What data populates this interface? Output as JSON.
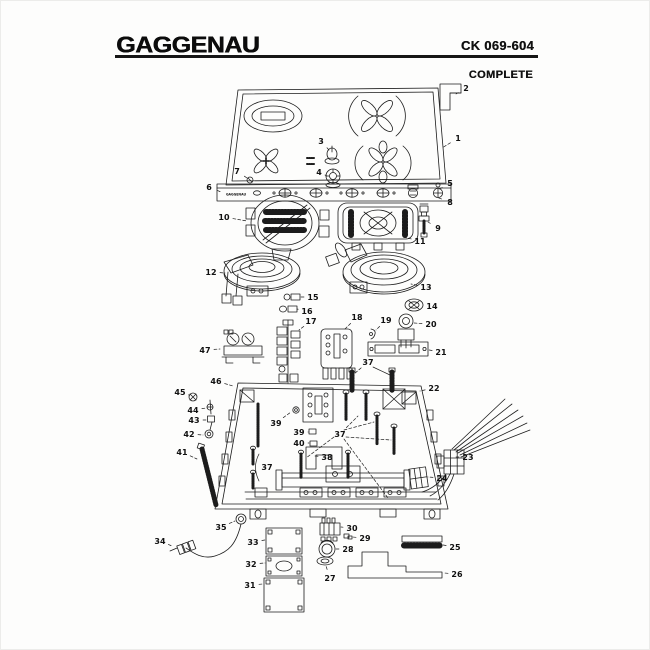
{
  "header": {
    "brand": "GAGGENAU",
    "model": "CK 069-604",
    "subtitle": "COMPLETE"
  },
  "diagram": {
    "strip_logo": "GAGGENAU",
    "labels": [
      {
        "n": "1",
        "x": 458,
        "y": 138,
        "tx": 442,
        "ty": 148
      },
      {
        "n": "2",
        "x": 466,
        "y": 88,
        "tx": 456,
        "ty": 94
      },
      {
        "n": "3",
        "x": 321,
        "y": 141,
        "tx": 329,
        "ty": 150
      },
      {
        "n": "4",
        "x": 319,
        "y": 172,
        "tx": 325,
        "ty": 175
      },
      {
        "n": "5",
        "x": 450,
        "y": 183,
        "tx": 438,
        "ty": 190
      },
      {
        "n": "6",
        "x": 209,
        "y": 187,
        "tx": 221,
        "ty": 192
      },
      {
        "n": "7",
        "x": 237,
        "y": 171,
        "tx": 247,
        "ty": 178
      },
      {
        "n": "8",
        "x": 450,
        "y": 202,
        "tx": 436,
        "ty": 197
      },
      {
        "n": "9",
        "x": 438,
        "y": 228,
        "tx": 428,
        "ty": 222
      },
      {
        "n": "10",
        "x": 224,
        "y": 217,
        "tx": 247,
        "ty": 221
      },
      {
        "n": "11",
        "x": 420,
        "y": 241,
        "tx": 403,
        "ty": 237
      },
      {
        "n": "12",
        "x": 211,
        "y": 272,
        "tx": 225,
        "ty": 273
      },
      {
        "n": "13",
        "x": 426,
        "y": 287,
        "tx": 411,
        "ty": 284
      },
      {
        "n": "14",
        "x": 432,
        "y": 306,
        "tx": 423,
        "ty": 305
      },
      {
        "n": "15",
        "x": 313,
        "y": 297,
        "tx": 300,
        "ty": 297
      },
      {
        "n": "16",
        "x": 307,
        "y": 311,
        "tx": 297,
        "ty": 309
      },
      {
        "n": "17",
        "x": 311,
        "y": 321,
        "tx": 299,
        "ty": 330
      },
      {
        "n": "18",
        "x": 357,
        "y": 317,
        "tx": 345,
        "ty": 329
      },
      {
        "n": "19",
        "x": 386,
        "y": 320,
        "tx": 376,
        "ty": 330
      },
      {
        "n": "20",
        "x": 431,
        "y": 324,
        "tx": 414,
        "ty": 323
      },
      {
        "n": "21",
        "x": 441,
        "y": 352,
        "tx": 429,
        "ty": 350
      },
      {
        "n": "22",
        "x": 434,
        "y": 388,
        "tx": 420,
        "ty": 391
      },
      {
        "n": "23",
        "x": 468,
        "y": 457,
        "tx": 455,
        "ty": 457
      },
      {
        "n": "24",
        "x": 442,
        "y": 478,
        "tx": 428,
        "ty": 477
      },
      {
        "n": "25",
        "x": 455,
        "y": 547,
        "tx": 443,
        "ty": 545
      },
      {
        "n": "26",
        "x": 457,
        "y": 574,
        "tx": 444,
        "ty": 573
      },
      {
        "n": "27",
        "x": 330,
        "y": 578,
        "tx": 326,
        "ty": 566
      },
      {
        "n": "28",
        "x": 348,
        "y": 549,
        "tx": 336,
        "ty": 549
      },
      {
        "n": "29",
        "x": 365,
        "y": 538,
        "tx": 352,
        "ty": 537
      },
      {
        "n": "30",
        "x": 352,
        "y": 528,
        "tx": 341,
        "ty": 527
      },
      {
        "n": "31",
        "x": 250,
        "y": 585,
        "tx": 263,
        "ty": 584
      },
      {
        "n": "32",
        "x": 251,
        "y": 564,
        "tx": 265,
        "ty": 563
      },
      {
        "n": "33",
        "x": 253,
        "y": 542,
        "tx": 265,
        "ty": 540
      },
      {
        "n": "34",
        "x": 160,
        "y": 541,
        "tx": 172,
        "ty": 546
      },
      {
        "n": "35",
        "x": 221,
        "y": 527,
        "tx": 235,
        "ty": 521
      },
      {
        "n": "37",
        "x": 368,
        "y": 362,
        "tx": 354,
        "ty": 374
      },
      {
        "n": "37",
        "x": 340,
        "y": 434,
        "tx": 358,
        "ty": 416
      },
      {
        "n": "37",
        "x": 267,
        "y": 467
      },
      {
        "n": "38",
        "x": 327,
        "y": 457,
        "tx": 315,
        "ty": 456
      },
      {
        "n": "39",
        "x": 276,
        "y": 423,
        "tx": 291,
        "ty": 412
      },
      {
        "n": "39",
        "x": 299,
        "y": 432,
        "tx": 308,
        "ty": 432
      },
      {
        "n": "40",
        "x": 299,
        "y": 443,
        "tx": 309,
        "ty": 443
      },
      {
        "n": "41",
        "x": 182,
        "y": 452,
        "tx": 197,
        "ty": 459
      },
      {
        "n": "42",
        "x": 189,
        "y": 434,
        "tx": 203,
        "ty": 435
      },
      {
        "n": "43",
        "x": 194,
        "y": 420,
        "tx": 206,
        "ty": 420
      },
      {
        "n": "44",
        "x": 193,
        "y": 410,
        "tx": 206,
        "ty": 408
      },
      {
        "n": "45",
        "x": 180,
        "y": 392,
        "tx": 189,
        "ty": 395
      },
      {
        "n": "46",
        "x": 216,
        "y": 381,
        "tx": 233,
        "ty": 386
      },
      {
        "n": "47",
        "x": 205,
        "y": 350,
        "tx": 220,
        "ty": 349
      }
    ]
  }
}
